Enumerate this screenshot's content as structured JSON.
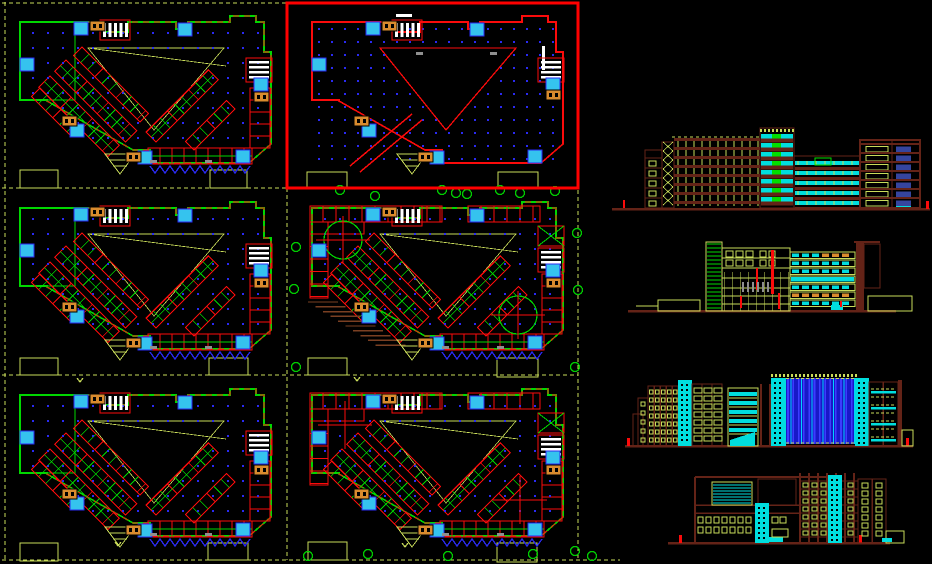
{
  "drawing": {
    "type": "cad-viewport",
    "canvas": {
      "width": 932,
      "height": 564,
      "background": "#000000"
    },
    "palette": {
      "green": "#00d800",
      "ygreen": "#c9dc5a",
      "red": "#fb0b0b",
      "selection_red": "#ff0000",
      "maroon": "#642317",
      "brown": "#7a3f22",
      "cyan": "#00dede",
      "cyan_box": "#35c3ee",
      "dot_blue": "#2a2af2",
      "stripe_blue": "#1818c8",
      "stripe_light": "#3c3cff",
      "window_blue": "#35459e",
      "orange": "#d98b2e",
      "white": "#ffffff",
      "gray": "#8f8f8f"
    },
    "selection": {
      "x": 287,
      "y": 3,
      "width": 291,
      "height": 185
    },
    "plans": [
      {
        "name": "floor-plan-1",
        "x": 0,
        "y": 2,
        "variant": "typical"
      },
      {
        "name": "floor-plan-2",
        "x": 292,
        "y": 2,
        "variant": "open",
        "selected": true
      },
      {
        "name": "floor-plan-3",
        "x": 0,
        "y": 188,
        "variant": "typical"
      },
      {
        "name": "floor-plan-4",
        "x": 292,
        "y": 188,
        "variant": "rooms",
        "circles": true,
        "hatch": true
      },
      {
        "name": "floor-plan-5",
        "x": 0,
        "y": 375,
        "variant": "typical"
      },
      {
        "name": "floor-plan-6",
        "x": 292,
        "y": 375,
        "variant": "rooms",
        "crosses": true
      }
    ],
    "plan_symbols": {
      "cyan_boxes": [
        [
          20,
          56
        ],
        [
          74,
          20
        ],
        [
          178,
          21
        ],
        [
          254,
          76
        ],
        [
          70,
          122
        ],
        [
          138,
          149
        ],
        [
          236,
          148
        ]
      ],
      "orange_boxes": [
        [
          90,
          19
        ],
        [
          62,
          114
        ],
        [
          126,
          150
        ],
        [
          254,
          90
        ]
      ],
      "triangle": [
        [
          88,
          46
        ],
        [
          224,
          46
        ],
        [
          154,
          128
        ]
      ],
      "left_bands": [
        {
          "x": 50,
          "y": 74,
          "len": 98,
          "h": 16
        },
        {
          "x": 66,
          "y": 58,
          "len": 100,
          "h": 16
        },
        {
          "x": 82,
          "y": 45,
          "len": 94,
          "h": 12
        },
        {
          "x": 40,
          "y": 86,
          "len": 56,
          "h": 12
        }
      ],
      "right_bands": [
        {
          "x": 156,
          "y": 140,
          "len": 88,
          "h": 14
        },
        {
          "x": 194,
          "y": 148,
          "len": 58,
          "h": 12
        }
      ]
    },
    "elevations": [
      {
        "name": "elevation-1",
        "x": 612,
        "y": 128,
        "style": "e1"
      },
      {
        "name": "elevation-2",
        "x": 628,
        "y": 238,
        "style": "e2"
      },
      {
        "name": "elevation-3",
        "x": 625,
        "y": 368,
        "style": "e3"
      },
      {
        "name": "elevation-4",
        "x": 668,
        "y": 465,
        "style": "e4"
      }
    ],
    "site": {
      "dash_h": [
        [
          2,
          3,
          286
        ],
        [
          2,
          188,
          286
        ],
        [
          290,
          188,
          578
        ],
        [
          2,
          375,
          286
        ],
        [
          290,
          375,
          578
        ],
        [
          2,
          560,
          620
        ]
      ],
      "dash_v": [
        [
          5,
          2,
          560
        ],
        [
          287,
          188,
          560
        ],
        [
          578,
          190,
          558
        ]
      ],
      "rects": [
        [
          20,
          170,
          38,
          18
        ],
        [
          210,
          170,
          37,
          18
        ],
        [
          307,
          172,
          40,
          16
        ],
        [
          498,
          172,
          40,
          16
        ],
        [
          20,
          358,
          38,
          17
        ],
        [
          209,
          358,
          39,
          17
        ],
        [
          308,
          358,
          39,
          17
        ],
        [
          497,
          358,
          41,
          19
        ],
        [
          20,
          543,
          38,
          18
        ],
        [
          208,
          543,
          40,
          17
        ],
        [
          308,
          542,
          39,
          18
        ],
        [
          497,
          543,
          40,
          19
        ]
      ]
    },
    "trees": [
      [
        340,
        190
      ],
      [
        442,
        190
      ],
      [
        456,
        193
      ],
      [
        500,
        190
      ],
      [
        555,
        191
      ],
      [
        577,
        233
      ],
      [
        296,
        247
      ],
      [
        294,
        289
      ],
      [
        578,
        290
      ],
      [
        375,
        196
      ],
      [
        467,
        194
      ],
      [
        520,
        193
      ],
      [
        575,
        367
      ],
      [
        296,
        367
      ],
      [
        308,
        556
      ],
      [
        368,
        554
      ],
      [
        448,
        556
      ],
      [
        533,
        554
      ],
      [
        592,
        556
      ],
      [
        575,
        551
      ]
    ],
    "tree_marks": [
      [
        80,
        378
      ],
      [
        357,
        377
      ],
      [
        118,
        542
      ],
      [
        405,
        543
      ]
    ]
  }
}
